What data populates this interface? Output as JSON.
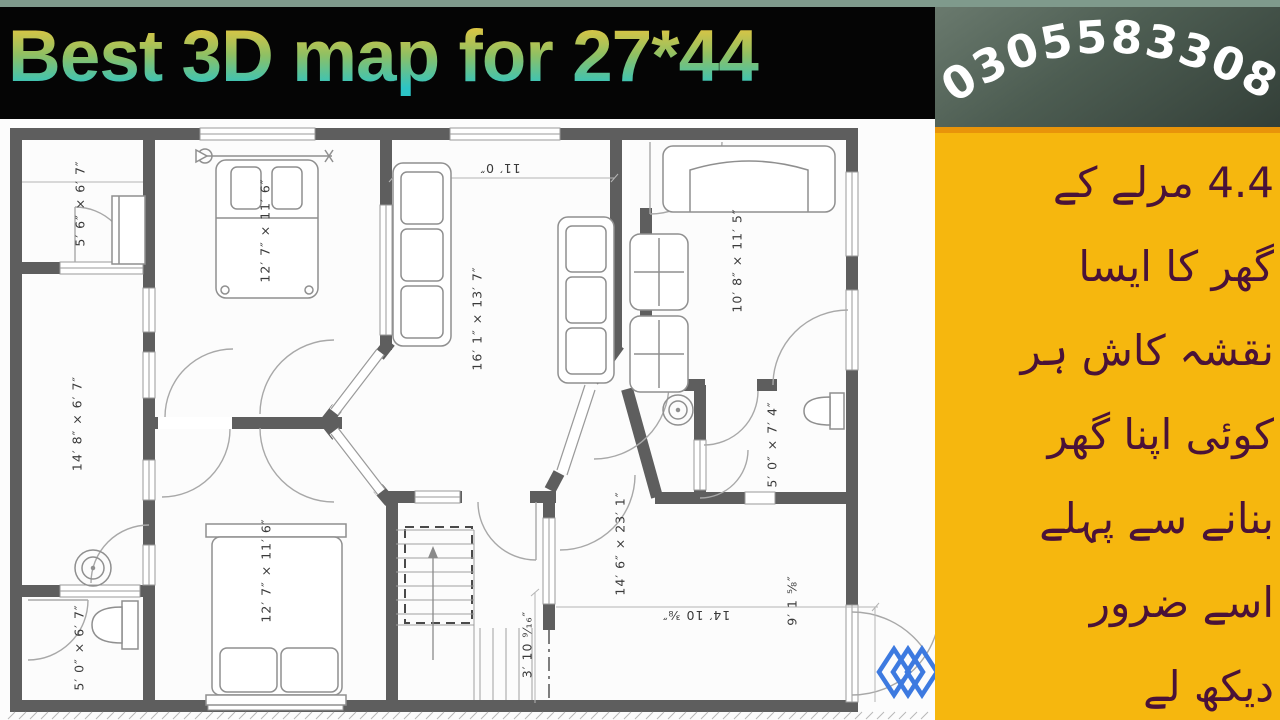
{
  "header": {
    "title": "Best 3D map for 27*44",
    "phone": "03055833087"
  },
  "side_panel": {
    "lines": [
      "4.4 مرلے کے",
      "گھر کا ایسا",
      "نقشہ کاش ہر",
      "کوئی اپنا گھر",
      "بنانے سے پہلے",
      "اسے ضرور",
      "دیکھ لے"
    ]
  },
  "floor_plan": {
    "labels": [
      {
        "text": "5′ 6″ × 6′ 7″"
      },
      {
        "text": "12′ 7″ × 11′ 6″"
      },
      {
        "text": "11′ 0″"
      },
      {
        "text": "16′ 1″ × 13′ 7″"
      },
      {
        "text": "10′ 8″ × 11′ 5″"
      },
      {
        "text": "14′ 8″ × 6′ 7″"
      },
      {
        "text": "5′ 0″ × 7′ 4″"
      },
      {
        "text": "5′ 0″ × 6′ 7″"
      },
      {
        "text": "12′ 7″ × 11′ 6″"
      },
      {
        "text": "14′ 6″ × 23′ 1″"
      },
      {
        "text": "3′ 10 ⁹⁄₁₆″"
      },
      {
        "text": "14′ 10 ⅜″"
      },
      {
        "text": "9′ 1 ⅝″"
      }
    ],
    "colors": {
      "wall": "#5E5E5E",
      "furniture_line": "#8F8F8F",
      "logo_blue": "#3D7AE0"
    }
  },
  "theme": {
    "panel_yellow": "#F6B70E",
    "panel_border_orange": "#E8940A",
    "urdu_text": "#4A1238",
    "title_gradient_top": "#EEC63C",
    "title_gradient_bottom": "#2CC4C6",
    "phone_text": "#FFFFFF",
    "phone_bg_dark": "#333F38"
  }
}
